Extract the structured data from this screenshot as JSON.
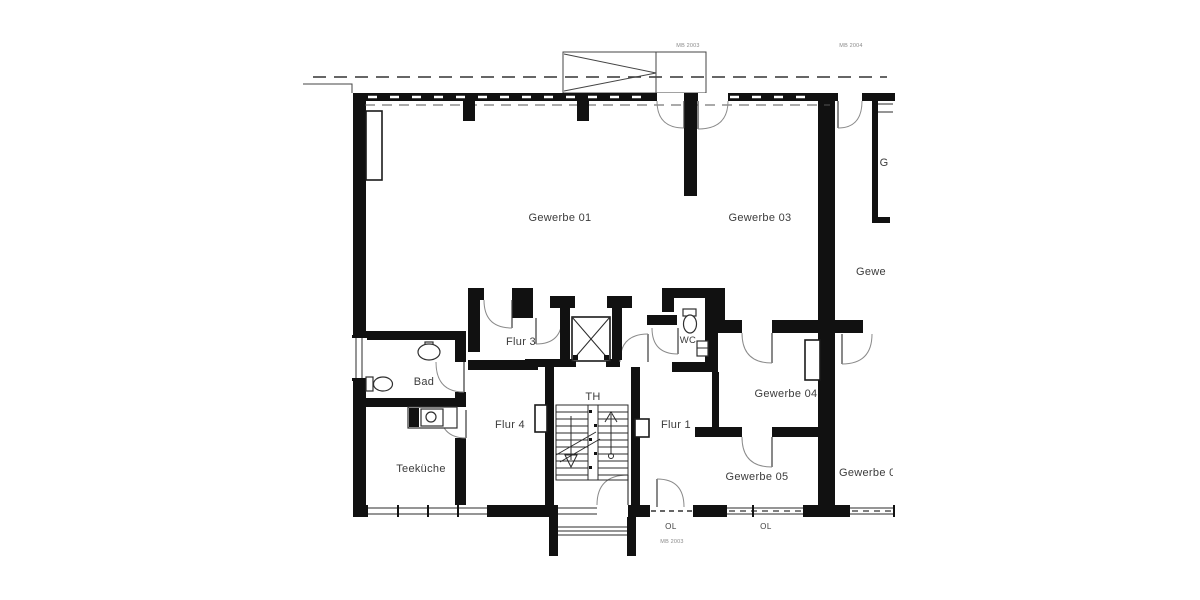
{
  "drawing": {
    "type": "architectural-floor-plan",
    "background_color": "#ffffff",
    "wall_color": "#111111",
    "text_color": "#3b3b3b",
    "rooms": [
      {
        "id": "gewerbe-01",
        "label": "Gewerbe 01"
      },
      {
        "id": "gewerbe-03",
        "label": "Gewerbe 03"
      },
      {
        "id": "flur-3",
        "label": "Flur 3"
      },
      {
        "id": "wc",
        "label": "WC"
      },
      {
        "id": "bad",
        "label": "Bad"
      },
      {
        "id": "th",
        "label": "TH"
      },
      {
        "id": "flur-4",
        "label": "Flur 4"
      },
      {
        "id": "flur-1",
        "label": "Flur 1"
      },
      {
        "id": "gewerbe-04",
        "label": "Gewerbe 04"
      },
      {
        "id": "teekueche",
        "label": "Teeküche"
      },
      {
        "id": "gewerbe-05",
        "label": "Gewerbe 05"
      },
      {
        "id": "gewerbe-right-top-partial",
        "label": "G"
      },
      {
        "id": "gewerbe-right-mid-partial",
        "label": "Gewe"
      },
      {
        "id": "gewerbe-right-bottom-partial",
        "label": "Gewerbe 0"
      }
    ],
    "annotations": [
      {
        "id": "ref-top-center",
        "label": "MB 2003"
      },
      {
        "id": "ref-top-right",
        "label": "MB 2004"
      },
      {
        "id": "skylight-left",
        "label": "OL"
      },
      {
        "id": "skylight-right",
        "label": "OL"
      },
      {
        "id": "ref-bottom-center",
        "label": "MB 2003"
      }
    ]
  }
}
